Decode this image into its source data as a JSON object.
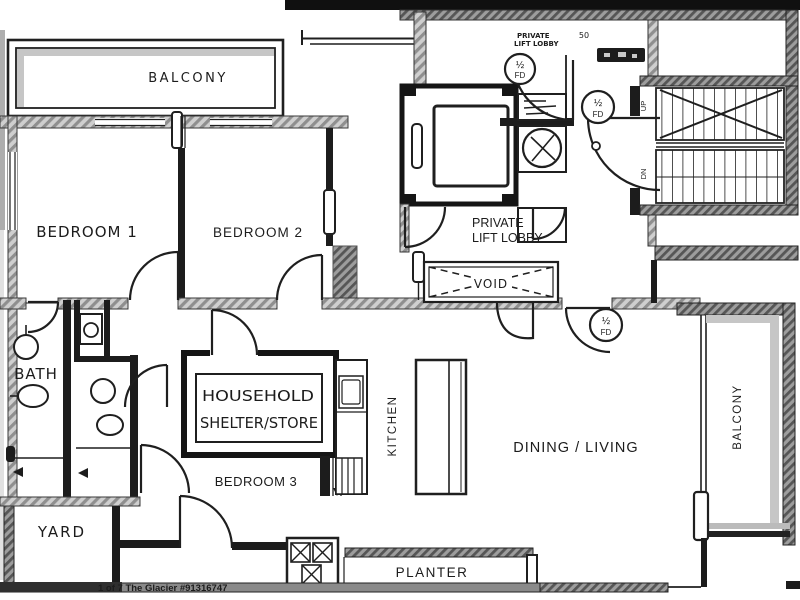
{
  "labels": {
    "balcony_top": "BALCONY",
    "bedroom1": "BEDROOM 1",
    "bedroom2": "BEDROOM 2",
    "bedroom3": "BEDROOM 3",
    "lobby_line1": "PRIVATE",
    "lobby_line2": "LIFT LOBBY",
    "dim_50": "50",
    "void": "VOID",
    "up": "UP",
    "dn": "DN",
    "bath": "BATH",
    "household_line1": "HOUSEHOLD",
    "household_line2": "SHELTER/STORE",
    "kitchen": "KITCHEN",
    "dining_living": "DINING / LIVING",
    "balcony_right": "BALCONY",
    "yard": "YARD",
    "planter": "PLANTER",
    "fd_top": "½",
    "fd_bottom": "FD",
    "watermark": "1 of 7 The Glacier #91316747"
  },
  "colors": {
    "background": "#ffffff",
    "ink": "#1c1c1c",
    "wall_gray": "#8f8f8f",
    "shade_gray": "#c6c6c6",
    "top_bar": "#101010"
  }
}
